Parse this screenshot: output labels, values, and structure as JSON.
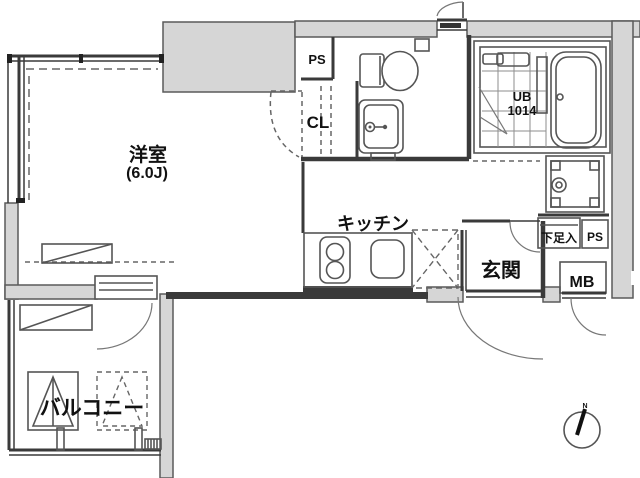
{
  "plan": {
    "labels": {
      "living_room": "洋室",
      "living_size": "(6.0J)",
      "balcony": "バルコニー",
      "kitchen": "キッチン",
      "entrance": "玄関",
      "closet": "CL",
      "pipe_space_top": "PS",
      "pipe_space_entry": "PS",
      "unit_bath": "UB",
      "unit_bath_size": "1014",
      "shoe_cabinet": "下足入",
      "meter_box": "MB"
    },
    "compass": {
      "north": "N"
    },
    "colors": {
      "wall_fill_gray": "#d6d6d6",
      "line": "#3a3a3a",
      "background": "#ffffff"
    }
  }
}
